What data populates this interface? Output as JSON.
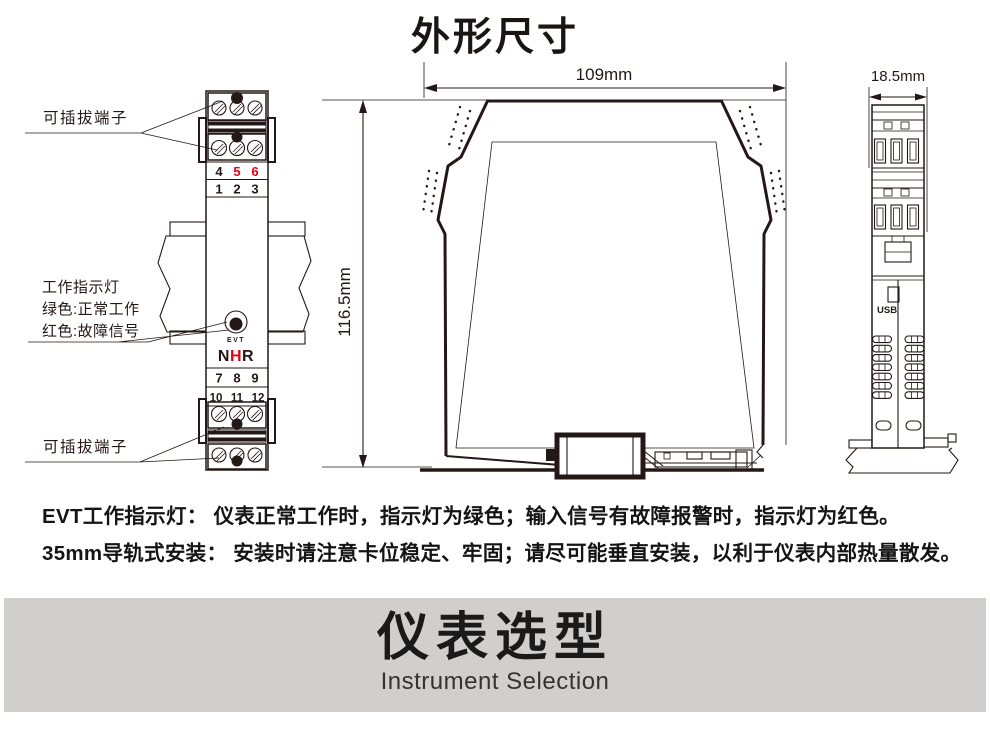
{
  "page": {
    "title": "外形尺寸"
  },
  "front_view": {
    "plug_terminal_label_top": "可插拔端子",
    "plug_terminal_label_bottom": "可插拔端子",
    "indicator_label": [
      "工作指示灯",
      "绿色:正常工作",
      "红色:故障信号"
    ],
    "terminal_numbers": {
      "row1": [
        "4",
        "5",
        "6"
      ],
      "row2": [
        "1",
        "2",
        "3"
      ],
      "row3": [
        "7",
        "8",
        "9"
      ],
      "row4": [
        "10",
        "11",
        "12"
      ]
    },
    "led_label": "EVT",
    "brand_letters": [
      "N",
      "H",
      "R"
    ]
  },
  "side_view": {
    "width_dim": "109mm",
    "height_dim": "116.5mm"
  },
  "end_view": {
    "width_dim": "18.5mm",
    "usb_label": "USB"
  },
  "notes": [
    "EVT工作指示灯： 仪表正常工作时，指示灯为绿色；输入信号有故障报警时，指示灯为红色。",
    "35mm导轨式安装： 安装时请注意卡位稳定、牢固；请尽可能垂直安装，以利于仪表内部热量散发。"
  ],
  "banner": {
    "title": "仪表选型",
    "subtitle": "Instrument Selection"
  },
  "colors": {
    "line": "#231815",
    "red": "#e60012",
    "banner_bg": "#d0cfce"
  }
}
